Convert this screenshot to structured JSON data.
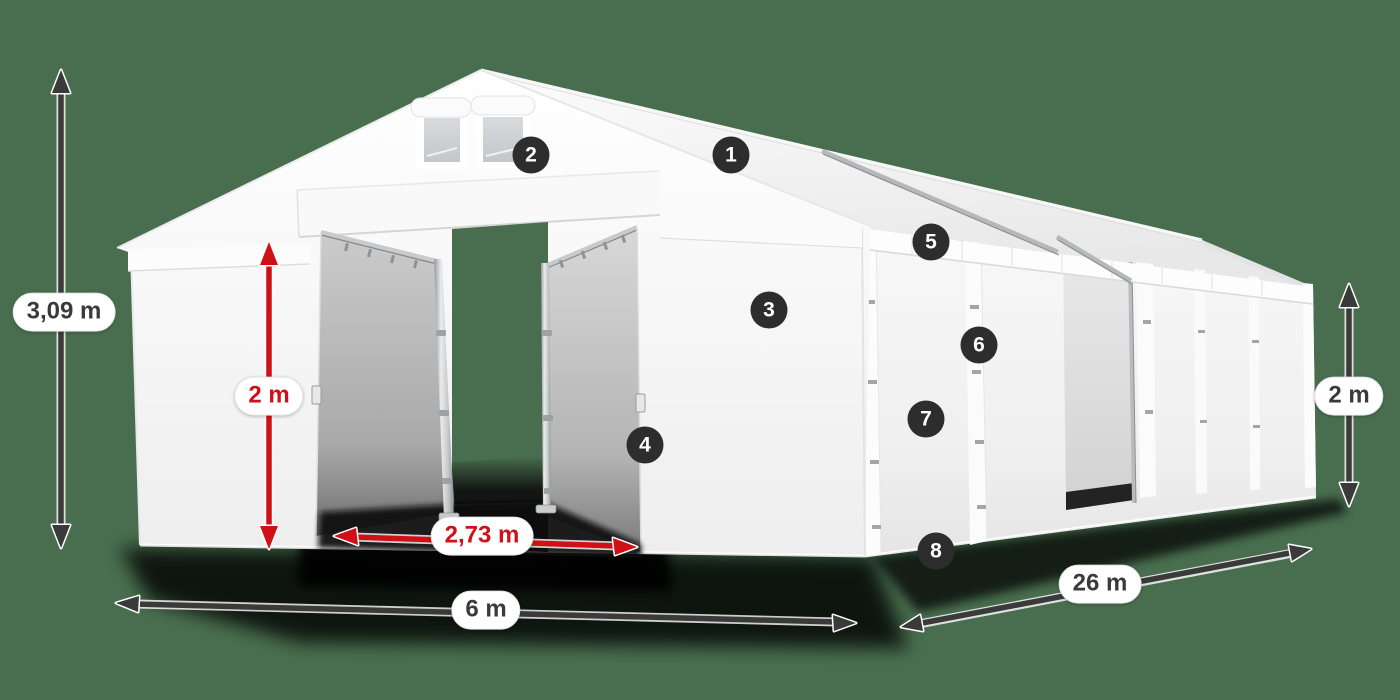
{
  "colors": {
    "background": "#496e4f",
    "badge": "#2d2d2d",
    "dark": "#3a3a3a",
    "red": "#cf1016"
  },
  "badges": {
    "b1": "1",
    "b2": "2",
    "b3": "3",
    "b4": "4",
    "b5": "5",
    "b6": "6",
    "b7": "7",
    "b8": "8"
  },
  "dimensions": {
    "total_height": "3,09 m",
    "door_height": "2 m",
    "door_width": "2,73 m",
    "front_width": "6 m",
    "length": "26 m",
    "side_height": "2 m"
  }
}
